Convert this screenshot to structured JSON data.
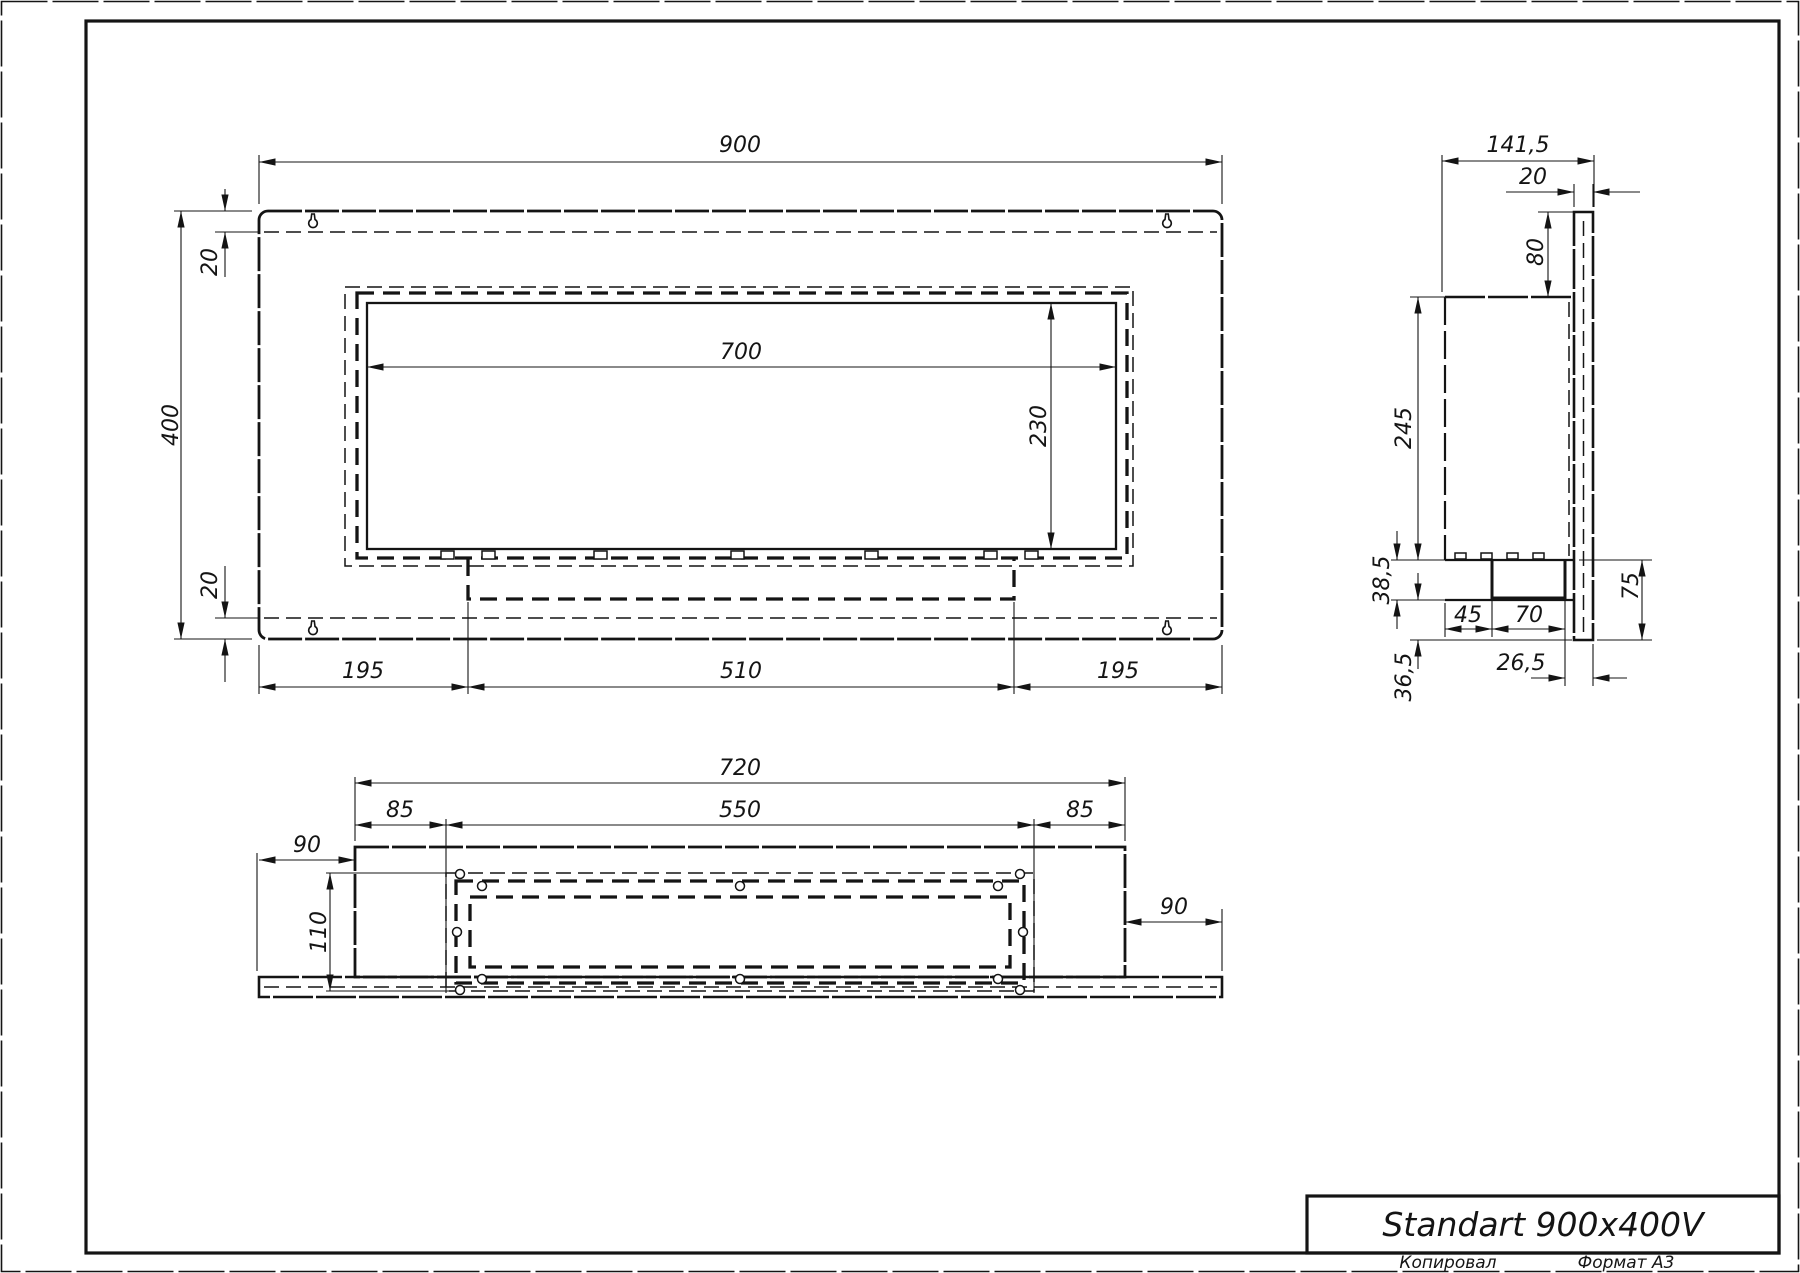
{
  "drawing": {
    "title": "Standart 900x400V",
    "footer": {
      "copied": "Копировал",
      "format": "Формат A3"
    }
  },
  "views": {
    "front": {
      "width": "900",
      "height": "400",
      "top_offset": "20",
      "bottom_offset": "20",
      "opening_width": "700",
      "opening_height": "230",
      "left_margin": "195",
      "burner_width": "510",
      "right_margin": "195"
    },
    "side": {
      "depth": "141,5",
      "wall_thickness": "20",
      "top_gap": "80",
      "body_height": "245",
      "lower_height": "38,5",
      "burner_offset": "45",
      "burner_width": "70",
      "right_height": "75",
      "bottom_offset": "26,5",
      "bottom_height": "36,5"
    },
    "top": {
      "body_width": "720",
      "side_inset_left": "85",
      "opening_width": "550",
      "side_inset_right": "85",
      "overhang_left": "90",
      "overhang_right": "90",
      "opening_depth": "110"
    }
  },
  "colors": {
    "line": "#141414",
    "paper": "#ffffff"
  }
}
